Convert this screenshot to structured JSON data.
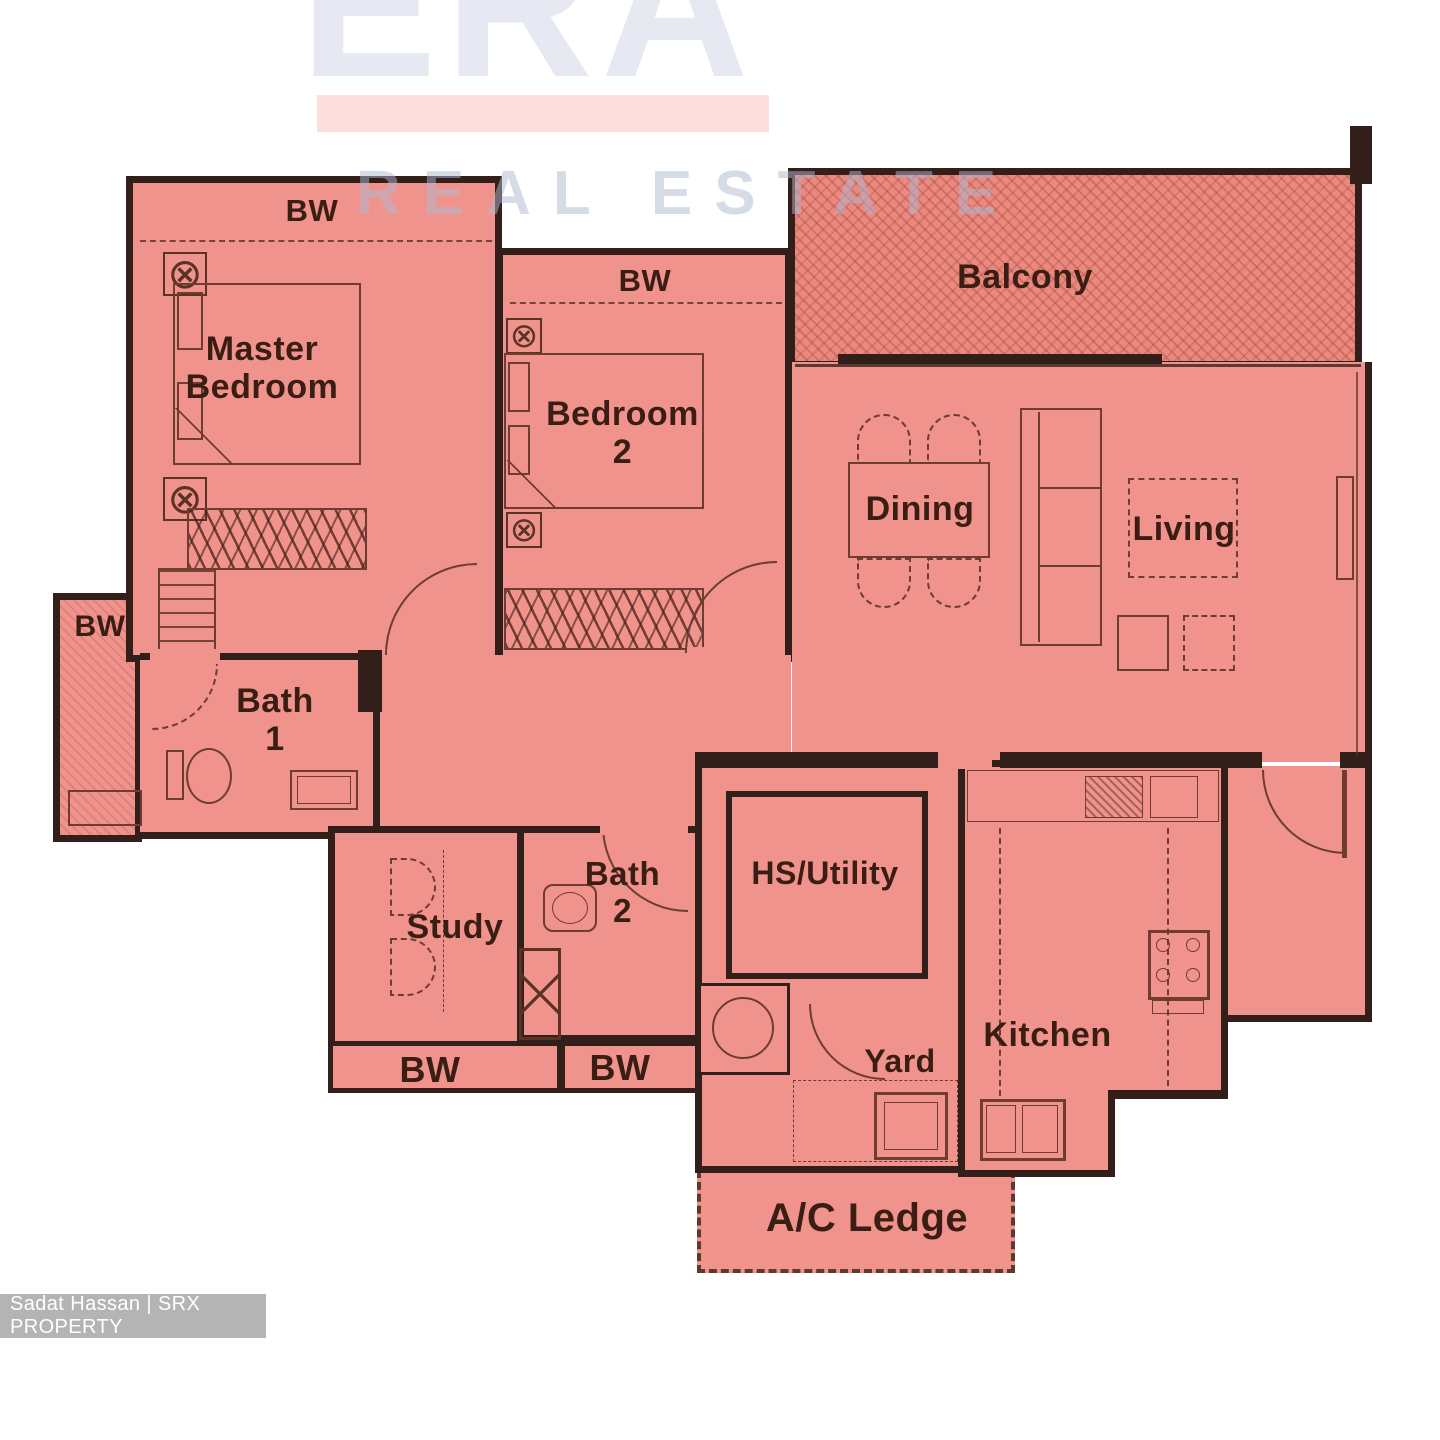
{
  "page": {
    "type": "residential floor plan listing image"
  },
  "watermark": {
    "brand": "ERA",
    "tagline": "REAL ESTATE"
  },
  "credit": {
    "text": "Sadat Hassan | SRX PROPERTY"
  },
  "labels": {
    "bw": "BW",
    "master_bedroom": "Master Bedroom",
    "bedroom2_l1": "Bedroom",
    "bedroom2_l2": "2",
    "balcony": "Balcony",
    "dining": "Dining",
    "living": "Living",
    "bath1_l1": "Bath",
    "bath1_l2": "1",
    "study": "Study",
    "bath2_l1": "Bath",
    "bath2_l2": "2",
    "hs_utility": "HS/Utility",
    "yard": "Yard",
    "kitchen": "Kitchen",
    "ac_ledge": "A/C Ledge"
  },
  "icons": {
    "vent": "⊗"
  },
  "colors": {
    "room_fill": "#f0938c",
    "balcony_fill": "#eb897e",
    "wall": "#331f1a",
    "furniture_line": "#6e3c30",
    "label_text": "#3a1d13",
    "era_letters": "#e6e9f1",
    "era_bar": "#fcdede",
    "tagline": "#aebad2",
    "credit_bg": "#b4b4b4",
    "credit_text": "#ffffff"
  }
}
